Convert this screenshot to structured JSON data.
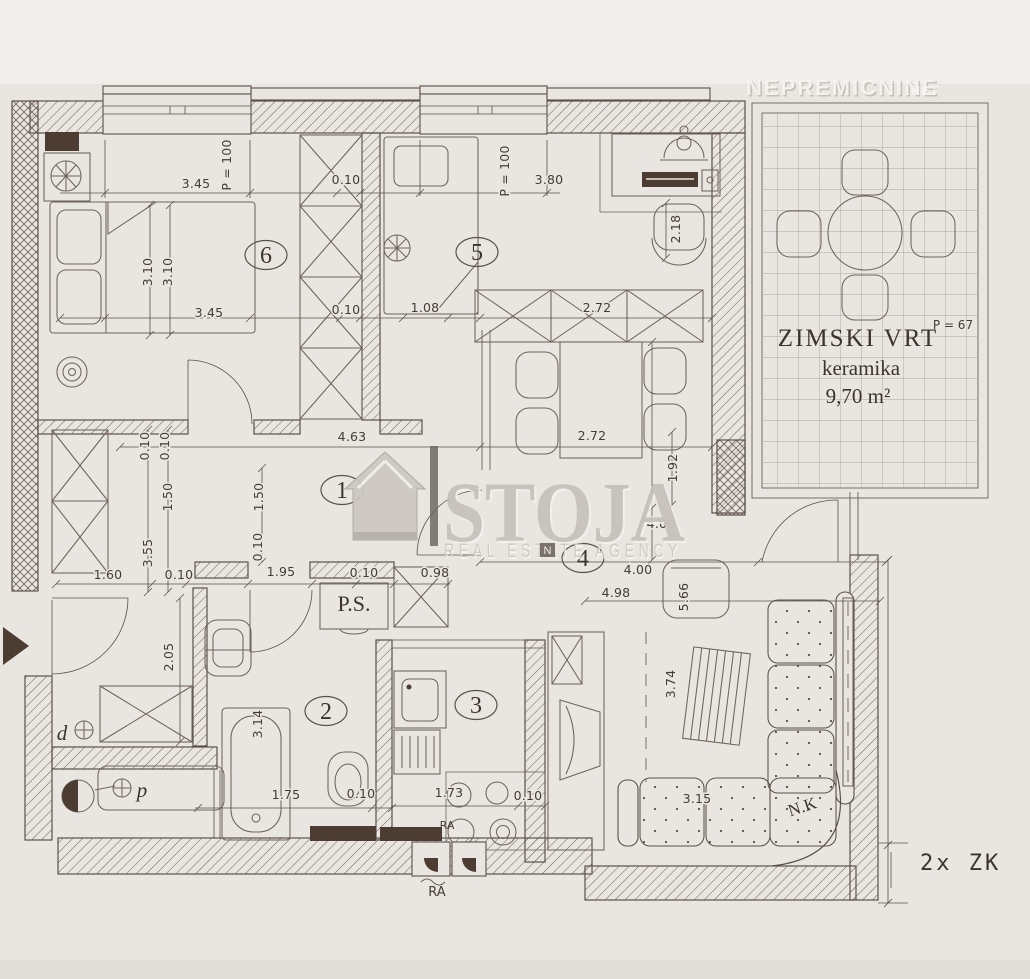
{
  "colors": {
    "paper": "#e9e6e1",
    "paper_light": "#f1f0ec",
    "ink": "#5b5049",
    "ink_light": "#6d6159",
    "dark_fill": "#4c3c31",
    "watermark_gray": "#c3bfb7",
    "watermark_white": "#f4f3f0"
  },
  "watermarks": {
    "portal": "NEPREMICNINE",
    "portal_suffix": ".NET",
    "agency": "STOJA",
    "agency_tagline": "REAL ESTATE AGENCY",
    "agency_mark": "N"
  },
  "winter_garden": {
    "name": "ZIMSKI VRT",
    "area_code": "P = 67",
    "floor_material": "keramika",
    "area": "9,70 m²"
  },
  "labels": {
    "pantry": "P.S.",
    "corner_bench": "N.K",
    "stove_ra": "RA",
    "vent_ra": "RA",
    "keys": "2x ZK",
    "drain": "d",
    "washer": "p"
  },
  "rooms": [
    {
      "number": "6",
      "cx": 266,
      "cy": 255
    },
    {
      "number": "5",
      "cx": 477,
      "cy": 252
    },
    {
      "number": "1",
      "cx": 342,
      "cy": 490
    },
    {
      "number": "4",
      "cx": 583,
      "cy": 558
    },
    {
      "number": "2",
      "cx": 326,
      "cy": 711
    },
    {
      "number": "3",
      "cx": 476,
      "cy": 705
    }
  ],
  "dimensions": [
    {
      "text": "3.45",
      "x": 196,
      "y": 188
    },
    {
      "text": "P = 100",
      "x": 231,
      "y": 165,
      "rot": -90
    },
    {
      "text": "0.10",
      "x": 346,
      "y": 184
    },
    {
      "text": "P = 100",
      "x": 509,
      "y": 171,
      "rot": -90
    },
    {
      "text": "3.80",
      "x": 549,
      "y": 184
    },
    {
      "text": "3.10",
      "x": 152,
      "y": 272,
      "rot": -90
    },
    {
      "text": "3.10",
      "x": 172,
      "y": 272,
      "rot": -90
    },
    {
      "text": "3.45",
      "x": 209,
      "y": 317
    },
    {
      "text": "0.10",
      "x": 346,
      "y": 314
    },
    {
      "text": "1.08",
      "x": 425,
      "y": 312
    },
    {
      "text": "2.72",
      "x": 597,
      "y": 312
    },
    {
      "text": "2.18",
      "x": 680,
      "y": 229,
      "rot": -90
    },
    {
      "text": "2.72",
      "x": 592,
      "y": 440
    },
    {
      "text": "4.63",
      "x": 352,
      "y": 441
    },
    {
      "text": "0.10",
      "x": 149,
      "y": 446,
      "rot": -90
    },
    {
      "text": "0.10",
      "x": 169,
      "y": 446,
      "rot": -90
    },
    {
      "text": "1.50",
      "x": 172,
      "y": 497,
      "rot": -90
    },
    {
      "text": "1.50",
      "x": 263,
      "y": 497,
      "rot": -90
    },
    {
      "text": "0.10",
      "x": 262,
      "y": 547,
      "rot": -90
    },
    {
      "text": "3.55",
      "x": 152,
      "y": 553,
      "rot": -90
    },
    {
      "text": "1.92",
      "x": 677,
      "y": 468,
      "rot": -90
    },
    {
      "text": "4.00",
      "x": 661,
      "y": 528
    },
    {
      "text": "4.00",
      "x": 638,
      "y": 574
    },
    {
      "text": "4.98",
      "x": 616,
      "y": 597
    },
    {
      "text": "1.60",
      "x": 108,
      "y": 579
    },
    {
      "text": "0.10",
      "x": 179,
      "y": 579
    },
    {
      "text": "1.95",
      "x": 281,
      "y": 576
    },
    {
      "text": "0.10",
      "x": 364,
      "y": 577
    },
    {
      "text": "0.98",
      "x": 435,
      "y": 577
    },
    {
      "text": "2.05",
      "x": 173,
      "y": 657,
      "rot": -90
    },
    {
      "text": "3.14",
      "x": 262,
      "y": 724,
      "rot": -90
    },
    {
      "text": "1.75",
      "x": 286,
      "y": 799
    },
    {
      "text": "0.10",
      "x": 361,
      "y": 798
    },
    {
      "text": "1.73",
      "x": 449,
      "y": 797
    },
    {
      "text": "0.10",
      "x": 528,
      "y": 800
    },
    {
      "text": "5.66",
      "x": 688,
      "y": 597,
      "rot": -90
    },
    {
      "text": "3.74",
      "x": 675,
      "y": 684,
      "rot": -90
    },
    {
      "text": "3.15",
      "x": 697,
      "y": 803
    }
  ]
}
